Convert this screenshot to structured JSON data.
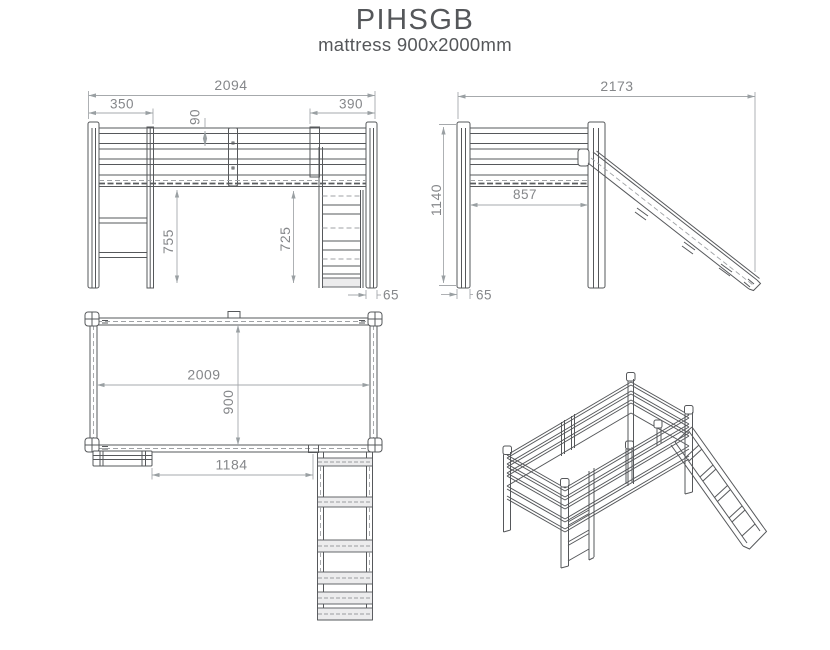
{
  "title": "PIHSGB",
  "subtitle": "mattress 900x2000mm",
  "views": {
    "front": {
      "dims": {
        "overall_length": "2094",
        "ladder_section": "350",
        "slide_section": "390",
        "rail_spacing": "90",
        "clearance_left": "755",
        "clearance_right": "725",
        "post_width": "65"
      }
    },
    "side": {
      "dims": {
        "overall_depth": "2173",
        "overall_height": "1140",
        "inner_width": "857",
        "post_width": "65"
      }
    },
    "top": {
      "dims": {
        "inner_length": "2009",
        "inner_width": "900",
        "ladder_to_slide": "1184"
      }
    }
  }
}
